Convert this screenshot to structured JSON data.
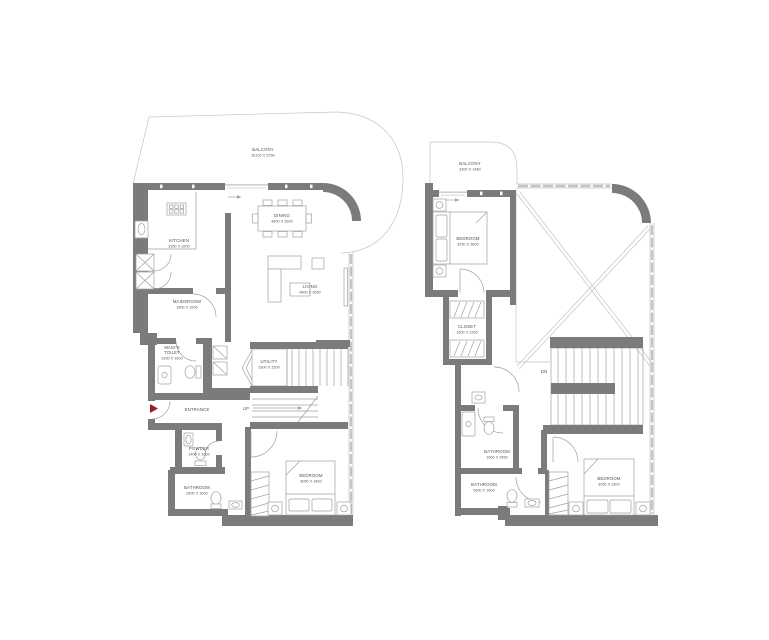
{
  "colors": {
    "background": "#ffffff",
    "wall": "#7b7b7b",
    "line": "#a0a0a0",
    "line_soft": "#c4c4c4",
    "text": "#4f4f4f",
    "entrance_marker": "#9e1b20"
  },
  "floor1": {
    "balcony": {
      "name": "BALCONY",
      "dims": "16100 X 2250"
    },
    "kitchen": {
      "name": "KITCHEN",
      "dims": "3350 X 3200"
    },
    "dining": {
      "name": "DINING",
      "dims": "4800 X 2600"
    },
    "living": {
      "name": "LIVING",
      "dims": "4800 X 3050"
    },
    "maidsroom": {
      "name": "MAIDSROOM",
      "dims": "1800 X 3200"
    },
    "maids_toilet": {
      "name_line1": "MAID'S",
      "name_line2": "TOILET",
      "dims": "2200 X 1600"
    },
    "entrance": {
      "name": "ENTRANCE"
    },
    "utility": {
      "name": "UTILITY",
      "dims": "1500 X 1200"
    },
    "up_label": "UP",
    "powder": {
      "name": "POWDER",
      "dims": "1400 X 1600"
    },
    "bathroom": {
      "name": "BATHROOM",
      "dims": "2600 X 1600"
    },
    "bedroom": {
      "name": "BEDROOM",
      "dims": "3050 X 3400"
    }
  },
  "floor2": {
    "balcony": {
      "name": "BALCONY",
      "dims": "3300 X 1480"
    },
    "bedroom_top": {
      "name": "BEDROOM",
      "dims": "3250 X 3600"
    },
    "closet": {
      "name": "CLOSET",
      "dims": "1500 X 2250"
    },
    "dn_label": "DN",
    "bathroom_upper": {
      "name": "BATHROOM",
      "dims": "1600 X 2650"
    },
    "bathroom_lower": {
      "name": "BATHROOM",
      "dims": "2600 X 1600"
    },
    "bedroom_bottom": {
      "name": "BEDROOM",
      "dims": "3050 X 3300"
    }
  }
}
